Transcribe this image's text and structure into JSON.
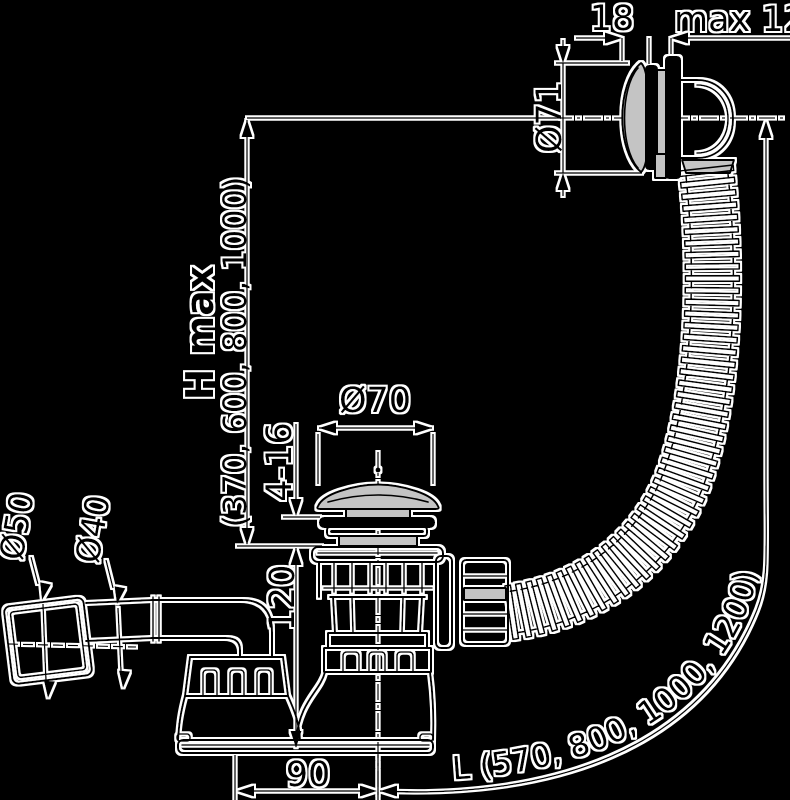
{
  "drawing": {
    "type": "technical-dimension-drawing",
    "subject": "bath waste and overflow drain set, side view",
    "background_color": "#000000",
    "line_color": "#000000",
    "halo_color": "#ffffff",
    "metal_fill_color": "#c4c4c4"
  },
  "labels": {
    "cap_depth": "18",
    "panel_thickness": "max 12",
    "overflow_cap_diameter": "Ø71",
    "install_height_name": "H max",
    "install_height_values": "(370, 600, 800, 1000)",
    "plug_cap_diameter": "Ø70",
    "clamping_range": "4-16",
    "sump_height": "120",
    "outlet_offset": "90",
    "socket_diameter": "Ø50",
    "outlet_pipe_diameter": "Ø40",
    "hose_length": "L (570, 800, 1000, 1200)"
  }
}
